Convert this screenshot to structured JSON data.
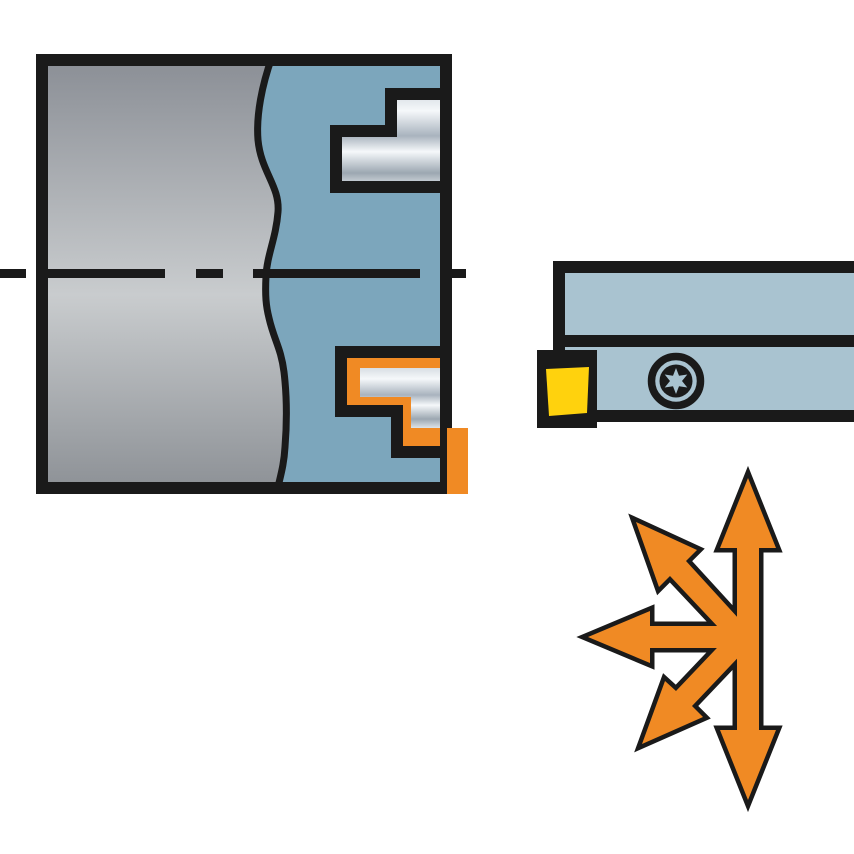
{
  "figure": {
    "kind": "machining-tool-illustration",
    "left_panel": "workpiece-cross-section-with-profiled-steps",
    "right_panel": "turning-tool-holder-with-insert",
    "bottom_panel": "multi-directional-feed-arrows"
  },
  "colors": {
    "background": "#FFFFFF",
    "outline": "#1A1A1A",
    "workpiece_blue": "#7CA6BC",
    "holder_blue": "#A9C3D0",
    "accent_orange": "#F08A24",
    "insert_yellow": "#FFD20D",
    "steel_dark": "#8C9097",
    "steel_light": "#C9CCCE",
    "steel_dark2": "#8F9398",
    "metal_edge": "#D8DEE4",
    "metal_hi": "#F5F8FA",
    "metal_mid": "#A9B3BE",
    "metal_mid2": "#9CA7B1",
    "metal_edge2": "#DDE3E8"
  },
  "icons": {
    "torx_screw": "torx-screw-icon",
    "feed_arrows": "multi-direction-arrows-icon"
  },
  "labels": {}
}
